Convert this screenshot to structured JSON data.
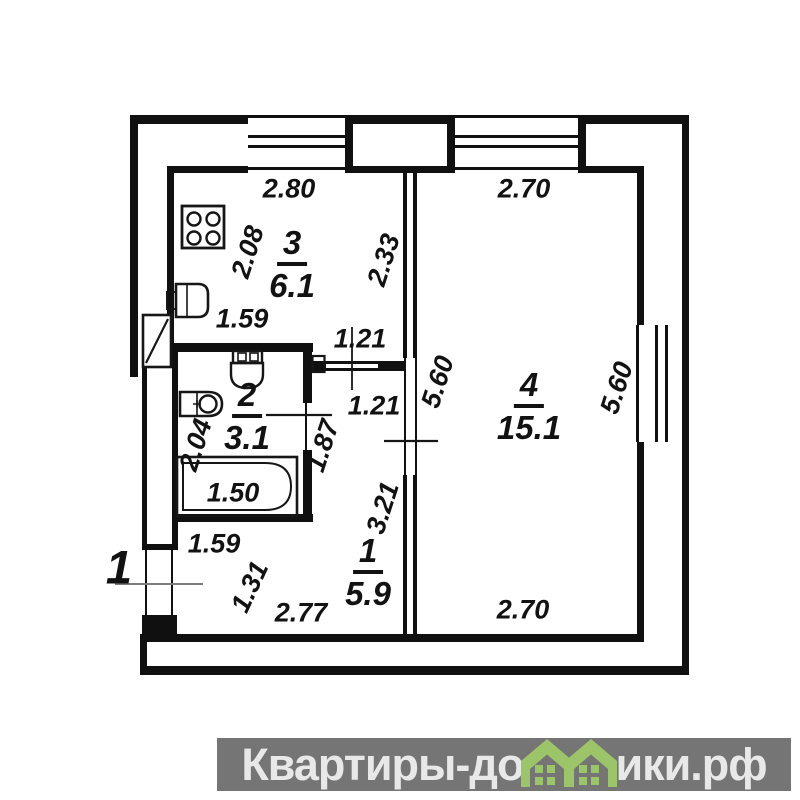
{
  "plan": {
    "unit_number": "1",
    "rooms": [
      {
        "id": "kitchen",
        "number": "3",
        "area": "6.1"
      },
      {
        "id": "bathroom",
        "number": "2",
        "area": "3.1"
      },
      {
        "id": "hallway",
        "number": "1",
        "area": "5.9"
      },
      {
        "id": "living-room",
        "number": "4",
        "area": "15.1"
      }
    ],
    "dimensions": {
      "kitchen_top": "2.80",
      "living_top": "2.70",
      "kitchen_left": "2.08",
      "kitchen_right": "2.33",
      "kitchen_bottom": "1.59",
      "opening_upper": "1.21",
      "opening_lower": "1.21",
      "living_left": "5.60",
      "living_right": "5.60",
      "bath_left": "2.04",
      "bath_right": "1.87",
      "bathtub_length": "1.50",
      "hall_right": "3.21",
      "bath_bottom": "1.59",
      "hall_left": "1.31",
      "hall_bottom": "2.77",
      "living_bottom": "2.70"
    },
    "fixtures": [
      "stove",
      "kitchen-sink",
      "toilet",
      "washbasin",
      "bathtub",
      "entrance-door"
    ],
    "wall_color": "#101010"
  },
  "watermark": {
    "text_left": "Квартиры-до",
    "text_right": "ики.рф",
    "band_color": "#757575",
    "text_color": "#e8e8e8",
    "house_color": "#9cc468",
    "house_icon": "green-houses-logo"
  }
}
